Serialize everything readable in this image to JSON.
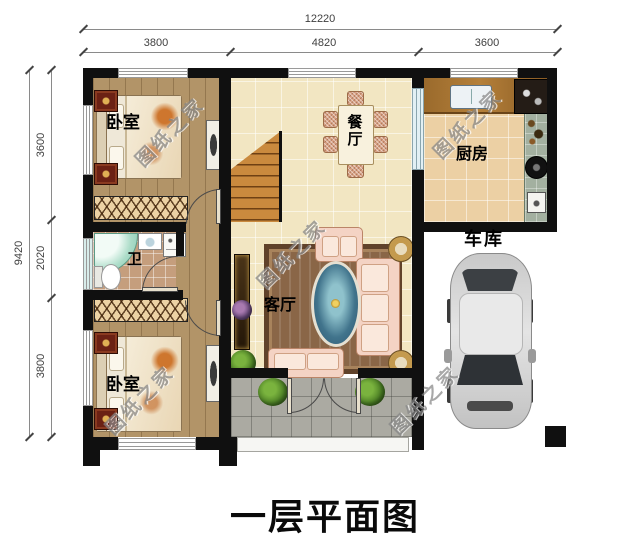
{
  "title": "一层平面图",
  "watermark_text": "图纸之家",
  "dimensions": {
    "top": {
      "total": "12220",
      "segments": [
        "3800",
        "4820",
        "3600"
      ]
    },
    "left": {
      "total": "9420",
      "segments": [
        "3600",
        "2020",
        "3800"
      ]
    }
  },
  "rooms": {
    "bedroom_top": "卧室",
    "bedroom_bottom": "卧室",
    "dining": "餐厅",
    "kitchen": "厨房",
    "bathroom": "卫",
    "living": "客厅",
    "garage": "车库"
  },
  "colors": {
    "wall": "#101010",
    "wood_floor": "#b29468",
    "tile_floor": "#f2e6c2",
    "kitchen_floor": "#ecd0a4",
    "bath_floor": "#c59e7d",
    "porch": "#abaaa2",
    "stairs": "#ca8a3e",
    "sofa": "#f4d3c4",
    "watermark": "#878787"
  }
}
